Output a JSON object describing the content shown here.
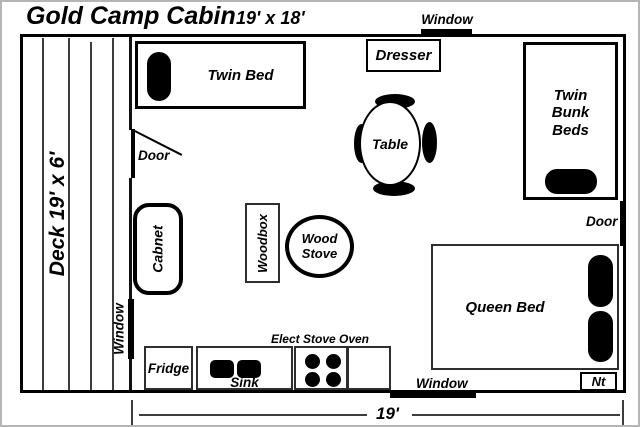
{
  "title": {
    "name": "Gold Camp Cabin",
    "size": "19' x 18'"
  },
  "deck": {
    "label": "Deck 19' x 6'"
  },
  "openings": {
    "window_top": "Window",
    "window_left": "Window",
    "window_bottom": "Window",
    "door_left": "Door",
    "door_right": "Door"
  },
  "furniture": {
    "twin_bed": "Twin Bed",
    "dresser": "Dresser",
    "twin_bunk_beds": "Twin Bunk Beds",
    "table": "Table",
    "cabinet": "Cabnet",
    "woodbox": "Woodbox",
    "wood_stove": "Wood Stove",
    "queen_bed": "Queen Bed",
    "nightstand": "Nt"
  },
  "kitchen": {
    "fridge": "Fridge",
    "sink": "Sink",
    "stove_oven": "Elect Stove Oven"
  },
  "dimension": {
    "width": "19'"
  },
  "colors": {
    "ink": "#000000",
    "paper": "#ffffff",
    "frame": "#b5b5b5"
  }
}
